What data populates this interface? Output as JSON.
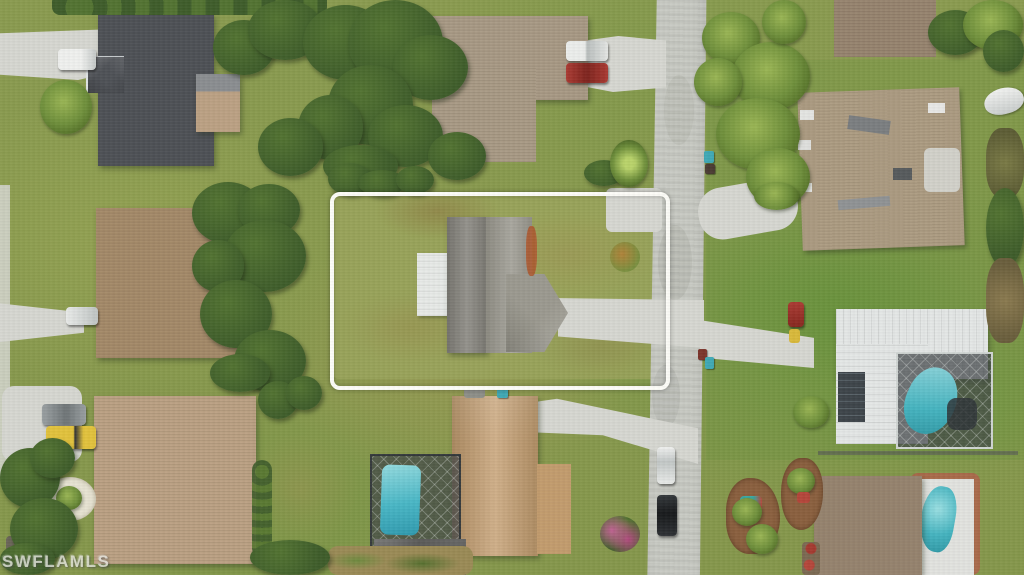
{
  "watermark": {
    "text": "SWFLAMLS"
  },
  "scene": {
    "type": "aerial-drone-photo",
    "subject": "vacant-look residential lot with gray-roof house outlined by white boundary rectangle",
    "boundary": {
      "shape": "rounded-rectangle",
      "color": "#fdfdf8"
    }
  },
  "colors": {
    "grass-base": "#8a9b4f",
    "grass-base2": "#85974b",
    "grass-lot": "#9aa55b",
    "road": "#c7c9c2",
    "concrete": "#d6d7d1",
    "roof-dark-gray": "#4e5156",
    "roof-brown": "#a58a69",
    "roof-tan": "#bba183",
    "roof-taupe": "#a99a85",
    "roof-gray": "#85837c",
    "roof-gray-light": "#9b998f",
    "roof-orange-tan": "#c59e6f",
    "roof-white-metal": "#e4e7e6",
    "roof-renov-tan": "#ad9c82",
    "roof-brgray": "#97846f",
    "carport-white": "#e7eae7",
    "pool-teal": "#45b4c0",
    "screen-dark": "#4a4f52",
    "tree-dark": "#3e5c2a",
    "tree-mid": "#527331",
    "palm-green": "#6f8f3b",
    "mulch-brown": "#8a5f3e",
    "boundary-white": "#fdfdf8",
    "car-red": "#ab3a32",
    "truck-yellow": "#e2c23c",
    "rust-patch": "#ad5a31",
    "watermark": "#e9e9e4"
  }
}
